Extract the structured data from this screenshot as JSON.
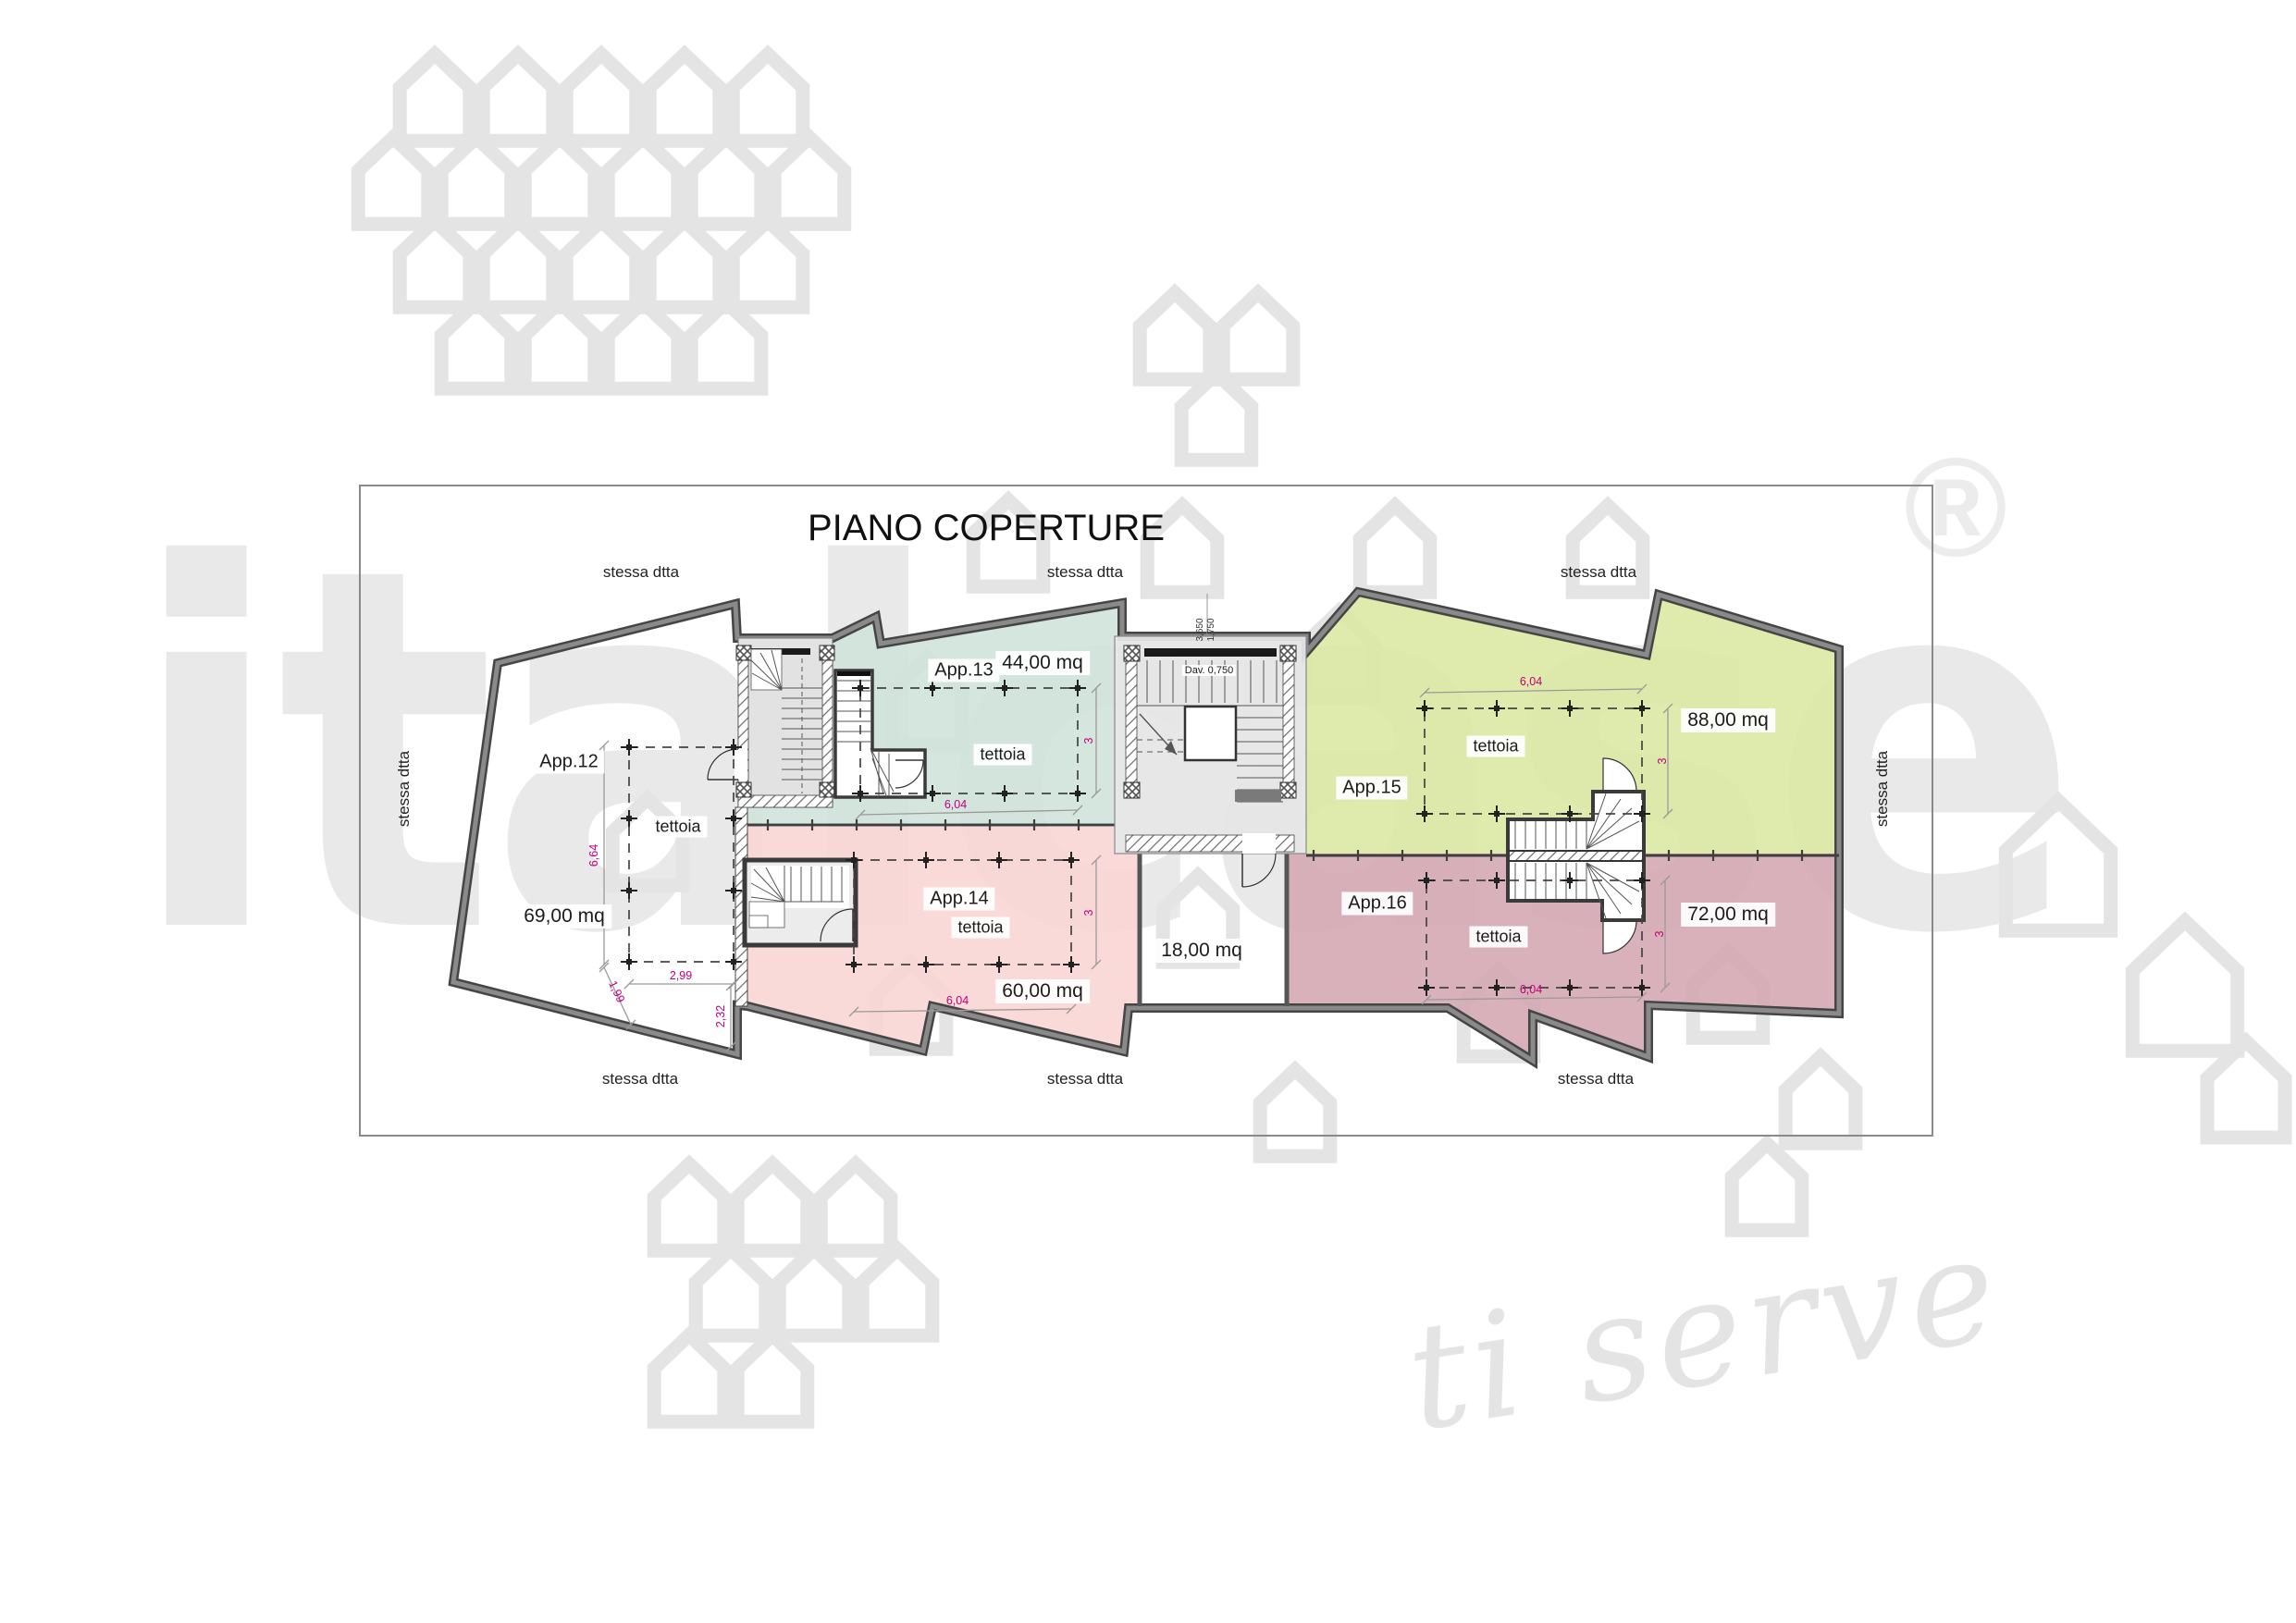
{
  "title": "PIANO COPERTURE",
  "watermark": {
    "brand": "italcase",
    "tagline": "ti serve",
    "registered": "®"
  },
  "labels": {
    "stessa_dtta": "stessa dtta",
    "tettoia": "tettoia",
    "sill_note": "Dav. 0,750"
  },
  "areas": {
    "terrace": "18,00 mq"
  },
  "apartments": [
    {
      "name": "App.12",
      "area": "69,00 mq"
    },
    {
      "name": "App.13",
      "area": "44,00 mq"
    },
    {
      "name": "App.14",
      "area": "60,00 mq"
    },
    {
      "name": "App.15",
      "area": "88,00 mq"
    },
    {
      "name": "App.16",
      "area": "72,00 mq"
    }
  ],
  "dimensions": {
    "bay_width": "6,04",
    "bay_depth": "3",
    "left_height": "6,64",
    "left_width": "2,99",
    "left_side": "1,99",
    "left_inner": "2,32",
    "stair_run": "1,750",
    "stair_total": "3,650"
  }
}
